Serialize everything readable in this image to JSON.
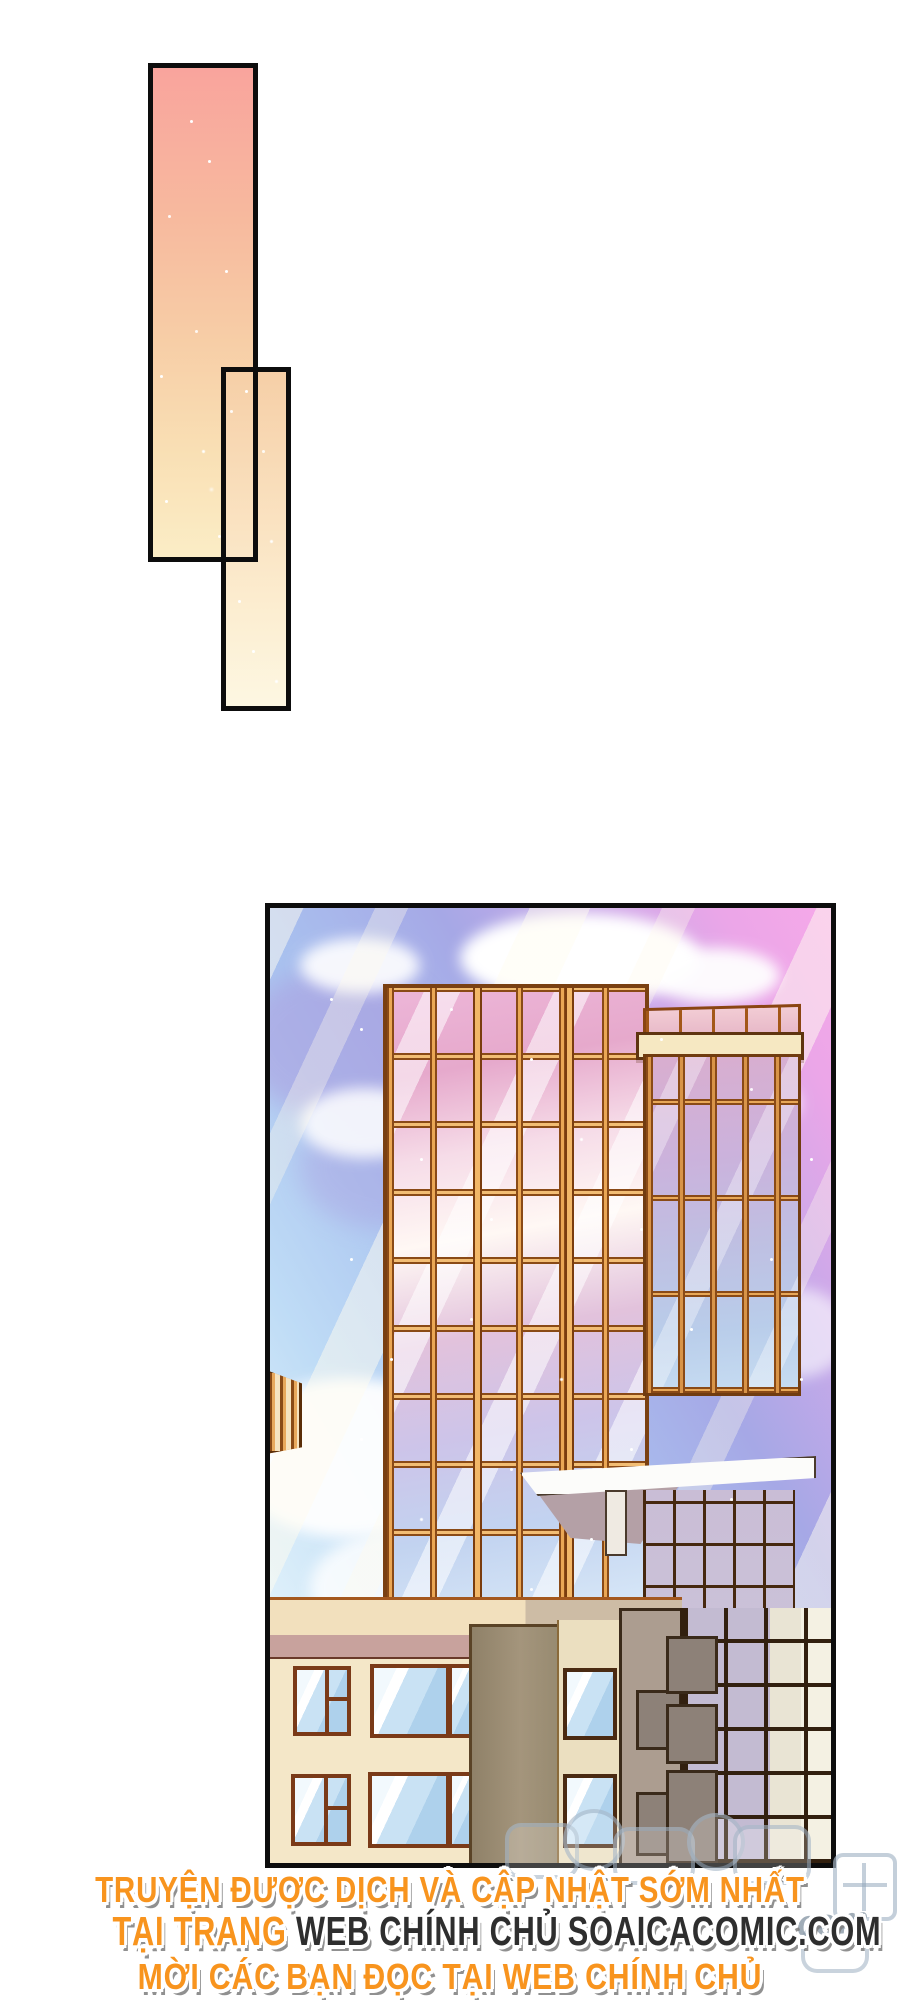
{
  "page": {
    "background": "#ffffff",
    "kind": "comic-page"
  },
  "footer": {
    "line1": "TRUYỆN ĐƯỢC DỊCH VÀ CẬP NHẬT SỚM NHẤT",
    "line2_orange": "TẠI TRANG ",
    "line2_dark": "WEB CHÍNH CHỦ SOAICACOMIC.COM",
    "line3": "MỜI CÁC BẠN ĐỌC TẠI WEB CHÍNH CHỦ",
    "orange_color": "#F8941E",
    "dark_color": "#2E2E2E",
    "outline_color": "#FFFFFF"
  },
  "watermark": {
    "latin_text": "com",
    "color": "#93A7B8"
  },
  "palette": {
    "panel_border": "#0D0D0D",
    "gradient_top": "#F9A49D",
    "gradient_bottom": "#FDF7E2",
    "sky_pink": "#F6A9E9",
    "sky_periwinkle": "#A6A8E6",
    "sky_blue": "#BFDCF6",
    "tower_frame_orange": "#C9822F",
    "tower_glass_pink": "#EDB6D8",
    "lowrise_cream": "#F4E7C8",
    "window_frame_brown": "#7A3A18",
    "dark_grid_brown": "#32200F"
  }
}
